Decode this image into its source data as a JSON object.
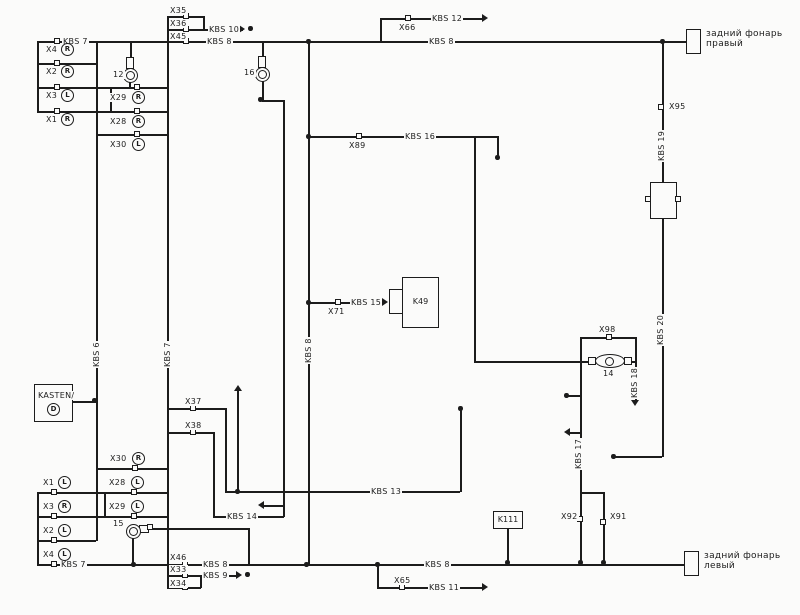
{
  "lamps": {
    "right": {
      "line1": "задний фонарь",
      "line2": "правый"
    },
    "left": {
      "line1": "задний фонарь",
      "line2": "левый"
    }
  },
  "components": {
    "kasten": "KASTEN/",
    "kasten_letter": "D",
    "k49": "K49",
    "k111": "K111",
    "bulb12": "12",
    "bulb16": "16",
    "bulb15": "15",
    "fuse14": "14"
  },
  "connectors": {
    "x35": "X35",
    "x36": "X36",
    "x45": "X45",
    "x37": "X37",
    "x38": "X38",
    "x46": "X46",
    "x33": "X33",
    "x34": "X34",
    "x65": "X65",
    "x66": "X66",
    "x71": "X71",
    "x89": "X89",
    "x91": "X91",
    "x92": "X92",
    "x95": "X95",
    "x98": "X98"
  },
  "pins_top_left": [
    {
      "name": "X4",
      "dir": "R"
    },
    {
      "name": "X2",
      "dir": "R"
    },
    {
      "name": "X3",
      "dir": "L"
    },
    {
      "name": "X1",
      "dir": "R"
    }
  ],
  "pins_top_mid": [
    {
      "name": "X29",
      "dir": "R"
    },
    {
      "name": "X28",
      "dir": "R"
    },
    {
      "name": "X30",
      "dir": "L"
    }
  ],
  "pins_bottom_left": [
    {
      "name": "X1",
      "dir": "L"
    },
    {
      "name": "X3",
      "dir": "R"
    },
    {
      "name": "X2",
      "dir": "L"
    },
    {
      "name": "X4",
      "dir": "L"
    }
  ],
  "pins_bottom_mid": [
    {
      "name": "X30",
      "dir": "R"
    },
    {
      "name": "X28",
      "dir": "L"
    },
    {
      "name": "X29",
      "dir": "L"
    }
  ],
  "wire_labels": {
    "kbs6": "KBS 6",
    "kbs7": "KBS 7",
    "kbs8": "KBS 8",
    "kbs9": "KBS 9",
    "kbs10": "KBS 10",
    "kbs11": "KBS 11",
    "kbs12": "KBS 12",
    "kbs13": "KBS 13",
    "kbs14": "KBS 14",
    "kbs15": "KBS 15",
    "kbs16": "KBS 16",
    "kbs17": "KBS 17",
    "kbs18": "KBS 18",
    "kbs19": "KBS 19",
    "kbs20": "KBS 20"
  }
}
